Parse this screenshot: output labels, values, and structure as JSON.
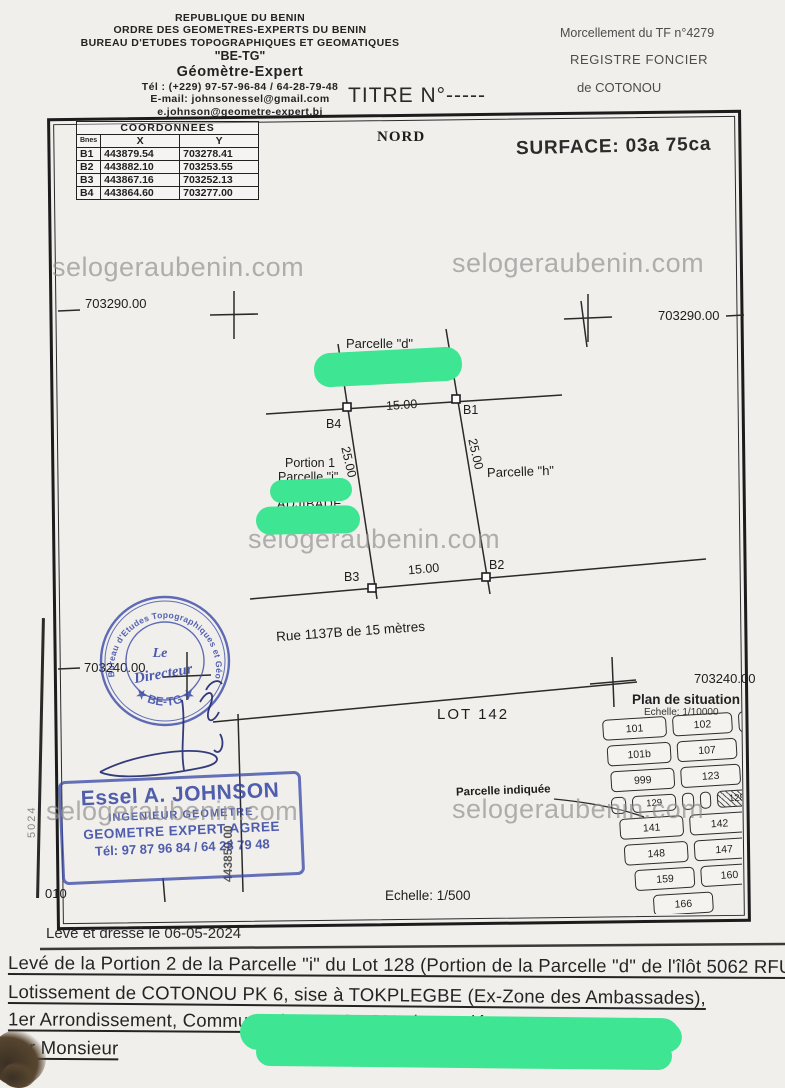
{
  "letterhead": {
    "line1": "REPUBLIQUE DU BENIN",
    "line2": "ORDRE DES GEOMETRES-EXPERTS DU BENIN",
    "line3": "BUREAU D'ETUDES TOPOGRAPHIQUES ET GEOMATIQUES",
    "line4": "\"BE-TG\"",
    "line5": "Géomètre-Expert",
    "line6": "Tél : (+229) 97-57-96-84 / 64-28-79-48",
    "line7": "E-mail: johnsonessel@gmail.com",
    "line8": "e.johnson@geometre-expert.bj"
  },
  "registry": {
    "morcellement": "Morcellement du TF n°4279",
    "registre": "REGISTRE FONCIER",
    "ville": "de COTONOU"
  },
  "title": "TITRE N°-----",
  "coordinates_table": {
    "title": "COORDONNEES",
    "columns": [
      "Bnes",
      "X",
      "Y"
    ],
    "rows": [
      [
        "B1",
        "443879.54",
        "703278.41"
      ],
      [
        "B2",
        "443882.10",
        "703253.55"
      ],
      [
        "B3",
        "443867.16",
        "703252.13"
      ],
      [
        "B4",
        "443864.60",
        "703277.00"
      ]
    ]
  },
  "plan": {
    "north": "NORD",
    "surface": "SURFACE: 03a 75ca",
    "grid": {
      "nw": "703290.00",
      "ne": "703290.00",
      "sw": "703240.00",
      "se": "703240.00",
      "easting": "443850.00",
      "margin_fragment": "5024"
    },
    "labels": {
      "parcelle_d": "Parcelle \"d\"",
      "owner_d_fragment": "yemi",
      "portion": "Portion 1",
      "parcelle_i": "Parcelle \"i\"",
      "owner_i": "ADJIBADE",
      "parcelle_h": "Parcelle \"h\"",
      "street": "Rue 1137B de 15 mètres",
      "lot": "LOT 142",
      "sheet": "010",
      "scale": "Echelle: 1/500"
    },
    "corners": {
      "b1": "B1",
      "b2": "B2",
      "b3": "B3",
      "b4": "B4"
    },
    "dims": {
      "top": "15.00",
      "bottom": "15.00",
      "left": "25.00",
      "right": "25.00"
    }
  },
  "situation": {
    "title": "Plan de situation",
    "scale": "Echelle: 1/10000",
    "pointer": "Parcelle indiquée",
    "lots": {
      "r0": [
        "101",
        "102",
        "10"
      ],
      "r1": [
        "101b",
        "107"
      ],
      "r2": [
        "999",
        "123"
      ],
      "r3": [
        "129",
        "128"
      ],
      "r4": [
        "141",
        "142"
      ],
      "r5": [
        "148",
        "147"
      ],
      "r6": [
        "159",
        "160"
      ],
      "r7": [
        "166"
      ]
    }
  },
  "stamps": {
    "round": {
      "ring_top": "Bureau d'Etudes Topographiques et Géomatiques",
      "ring_bottom": "★ BE-TG ★",
      "center1": "Le",
      "center2": "Directeur"
    },
    "box": {
      "name": "Essel A. JOHNSON",
      "role1": "INGENIEUR GEOMETRE",
      "role2": "GEOMETRE EXPERT AGREE",
      "phone": "Tél: 97 87 96 84 / 64 28 79 48"
    }
  },
  "watermark": "selogeraubenin.com",
  "footer": {
    "dated": "Levé et dressé le 06-05-2024",
    "line1": "Levé de la Portion 2 de la Parcelle \"i\" du Lot 128 (Portion de la Parcelle \"d\" de l'îlôt 5062 RFU",
    "line2": "Lotissement de COTONOU PK 6, sise à TOKPLEGBE (Ex-Zone des Ambassades),",
    "line3": "1er Arrondissement, Commune de COTONOU, demandé",
    "line4": "par Monsieur"
  },
  "colors": {
    "redaction_green": "#3ee592",
    "stamp_blue": "#3a4aa8",
    "watermark_gray": "#8f8f8f"
  }
}
